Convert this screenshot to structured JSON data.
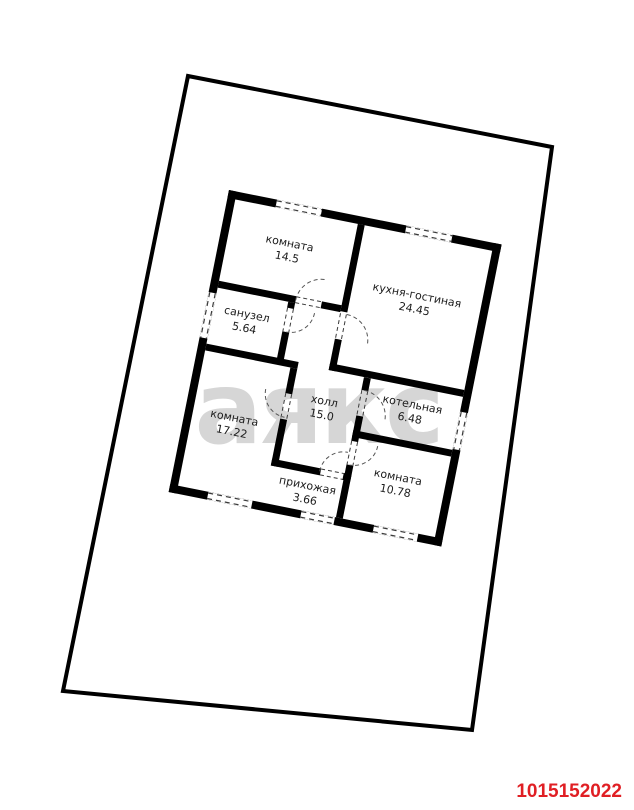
{
  "plan": {
    "rooms": [
      {
        "name": "комната",
        "area": "14.5"
      },
      {
        "name": "кухня-гостиная",
        "area": "24.45"
      },
      {
        "name": "санузел",
        "area": "5.64"
      },
      {
        "name": "холл",
        "area": "15.0"
      },
      {
        "name": "котельная",
        "area": "6.48"
      },
      {
        "name": "комната",
        "area": "17.22"
      },
      {
        "name": "комната",
        "area": "10.78"
      },
      {
        "name": "прихожая",
        "area": "3.66"
      }
    ]
  },
  "watermark": {
    "text": "аякс"
  },
  "listing_id": "1015152022",
  "colors": {
    "wall": "#000000",
    "boundary": "#000000",
    "watermark": "#d6d6d6",
    "listing_id": "#e01f24",
    "dash": "#3a3a3a"
  }
}
